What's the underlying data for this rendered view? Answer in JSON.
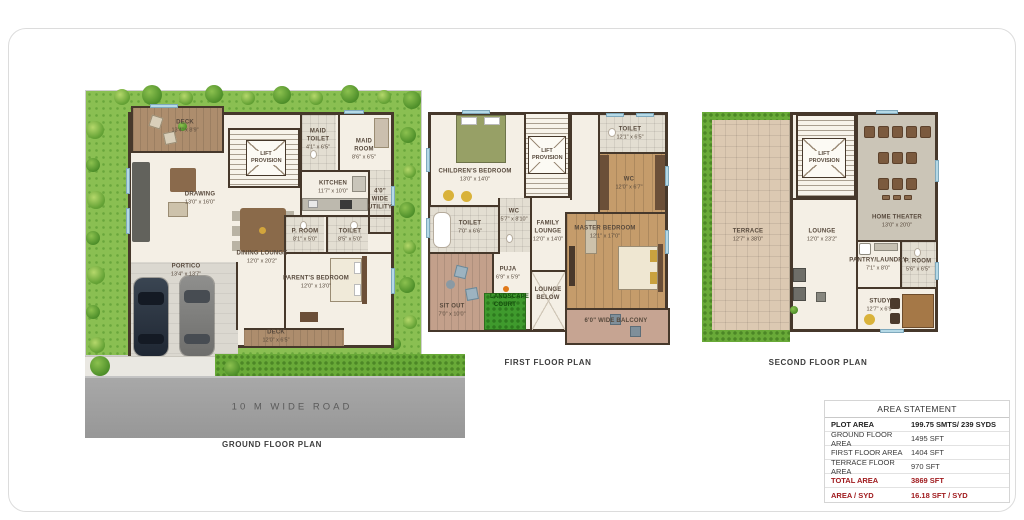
{
  "captions": {
    "ground": "GROUND FLOOR PLAN",
    "first": "FIRST FLOOR PLAN",
    "second": "SECOND FLOOR PLAN"
  },
  "road": {
    "label": "10 M WIDE ROAD"
  },
  "ground_floor": {
    "rooms": {
      "deck_top": {
        "name": "DECK",
        "dims": "13'4\" x 8'9\""
      },
      "drawing": {
        "name": "DRAWING",
        "dims": "13'0\" x 16'0\""
      },
      "lift": {
        "name": "LIFT PROVISION"
      },
      "maid_toilet": {
        "name": "MAID TOILET",
        "dims": "4'1\" x 6'5\""
      },
      "maid_room": {
        "name": "MAID ROOM",
        "dims": "8'6\" x 6'5\""
      },
      "kitchen": {
        "name": "KITCHEN",
        "dims": "11'7\" x 10'0\""
      },
      "utility": {
        "name": "4'0\" WIDE UTILITY"
      },
      "dining": {
        "name": "DINING LOUNGE",
        "dims": "12'0\" x 20'2\""
      },
      "portico": {
        "name": "PORTICO",
        "dims": "13'4\" x 13'7\""
      },
      "p_room": {
        "name": "P. ROOM",
        "dims": "8'1\" x 5'0\""
      },
      "toilet": {
        "name": "TOILET",
        "dims": "8'5\" x 5'0\""
      },
      "parents_bedroom": {
        "name": "PARENT'S BEDROOM",
        "dims": "12'0\" x 13'0\""
      },
      "deck_bottom": {
        "name": "DECK",
        "dims": "12'0\" x 6'5\""
      }
    }
  },
  "first_floor": {
    "rooms": {
      "childrens_bedroom": {
        "name": "CHILDREN'S BEDROOM",
        "dims": "13'0\" x 14'0\""
      },
      "lift": {
        "name": "LIFT PROVISION"
      },
      "toilet_top": {
        "name": "TOILET",
        "dims": "12'1\" x 6'5\""
      },
      "wc_top": {
        "name": "WC",
        "dims": "12'0\" x 6'7\""
      },
      "master_bedroom": {
        "name": "MASTER BEDROOM",
        "dims": "12'1\" x 17'0\""
      },
      "toilet_left": {
        "name": "TOILET",
        "dims": "7'0\" x 6'6\""
      },
      "wc_left": {
        "name": "WC",
        "dims": "5'7\" x 8'10\""
      },
      "family_lounge": {
        "name": "FAMILY LOUNGE",
        "dims": "12'0\" x 14'0\""
      },
      "sit_out": {
        "name": "SIT OUT",
        "dims": "7'0\" x 10'0\""
      },
      "puja": {
        "name": "PUJA",
        "dims": "6'9\" x 5'9\""
      },
      "landscape_court": {
        "name": "LANDSCAPE COURT"
      },
      "lounge_below": {
        "name": "LOUNGE BELOW"
      },
      "balcony": {
        "name": "6'0\" WIDE BALCONY"
      }
    }
  },
  "second_floor": {
    "rooms": {
      "terrace": {
        "name": "TERRACE",
        "dims": "12'7\" x 38'0\""
      },
      "lift": {
        "name": "LIFT PROVISION"
      },
      "home_theater": {
        "name": "HOME THEATER",
        "dims": "13'0\" x 20'0\""
      },
      "lounge": {
        "name": "LOUNGE",
        "dims": "12'0\" x 23'2\""
      },
      "pantry_laundry": {
        "name": "PANTRY/LAUNDRY",
        "dims": "7'1\" x 8'0\""
      },
      "p_room": {
        "name": "P. ROOM",
        "dims": "5'6\" x 6'5\""
      },
      "study": {
        "name": "STUDY",
        "dims": "12'7\" x 6'9\""
      }
    }
  },
  "area_statement": {
    "title": "AREA STATEMENT",
    "rows": [
      {
        "label": "PLOT AREA",
        "value": "199.75 SMTS/ 239 SYDS"
      },
      {
        "label": "GROUND FLOOR AREA",
        "value": "1495 SFT"
      },
      {
        "label": "FIRST FLOOR AREA",
        "value": "1404 SFT"
      },
      {
        "label": "TERRACE FLOOR AREA",
        "value": "970 SFT"
      },
      {
        "label": "TOTAL  AREA",
        "value": "3869 SFT"
      },
      {
        "label": "AREA / SYD",
        "value": "16.18 SFT / SYD"
      }
    ]
  }
}
